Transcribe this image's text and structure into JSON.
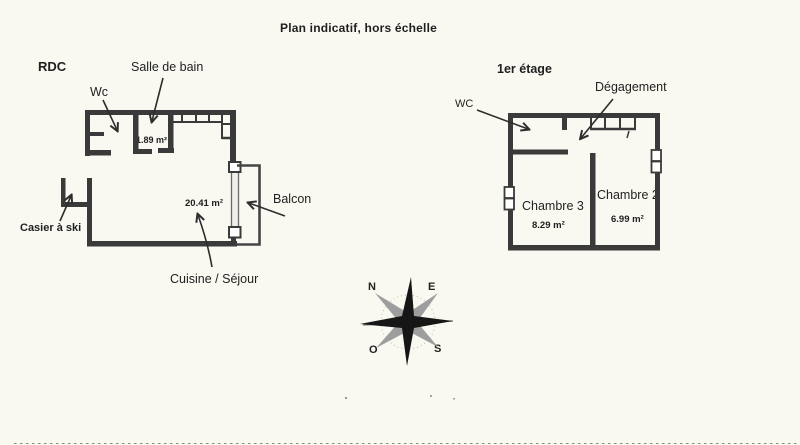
{
  "title": "Plan indicatif, hors échelle",
  "colors": {
    "background": "#f9f8f1",
    "wall": "#3a3a3a",
    "text": "#1f1f1f",
    "compass_gray": "#9e9e9e",
    "compass_black": "#161616"
  },
  "rdc": {
    "name": "RDC",
    "labels": {
      "wc": "Wc",
      "salle_de_bain": "Salle de bain",
      "salle_de_bain_area": "1.89 m²",
      "cuisine_sejour": "Cuisine / Séjour",
      "cuisine_sejour_area": "20.41 m²",
      "balcon": "Balcon",
      "casier_a_ski": "Casier à ski"
    }
  },
  "etage": {
    "name": "1er étage",
    "labels": {
      "wc": "WC",
      "degagement": "Dégagement",
      "chambre_3": "Chambre 3",
      "chambre_3_area": "8.29 m²",
      "chambre_2": "Chambre 2",
      "chambre_2_area": "6.99 m²"
    }
  },
  "compass": {
    "n": "N",
    "e": "E",
    "o": "O",
    "s": "S"
  }
}
